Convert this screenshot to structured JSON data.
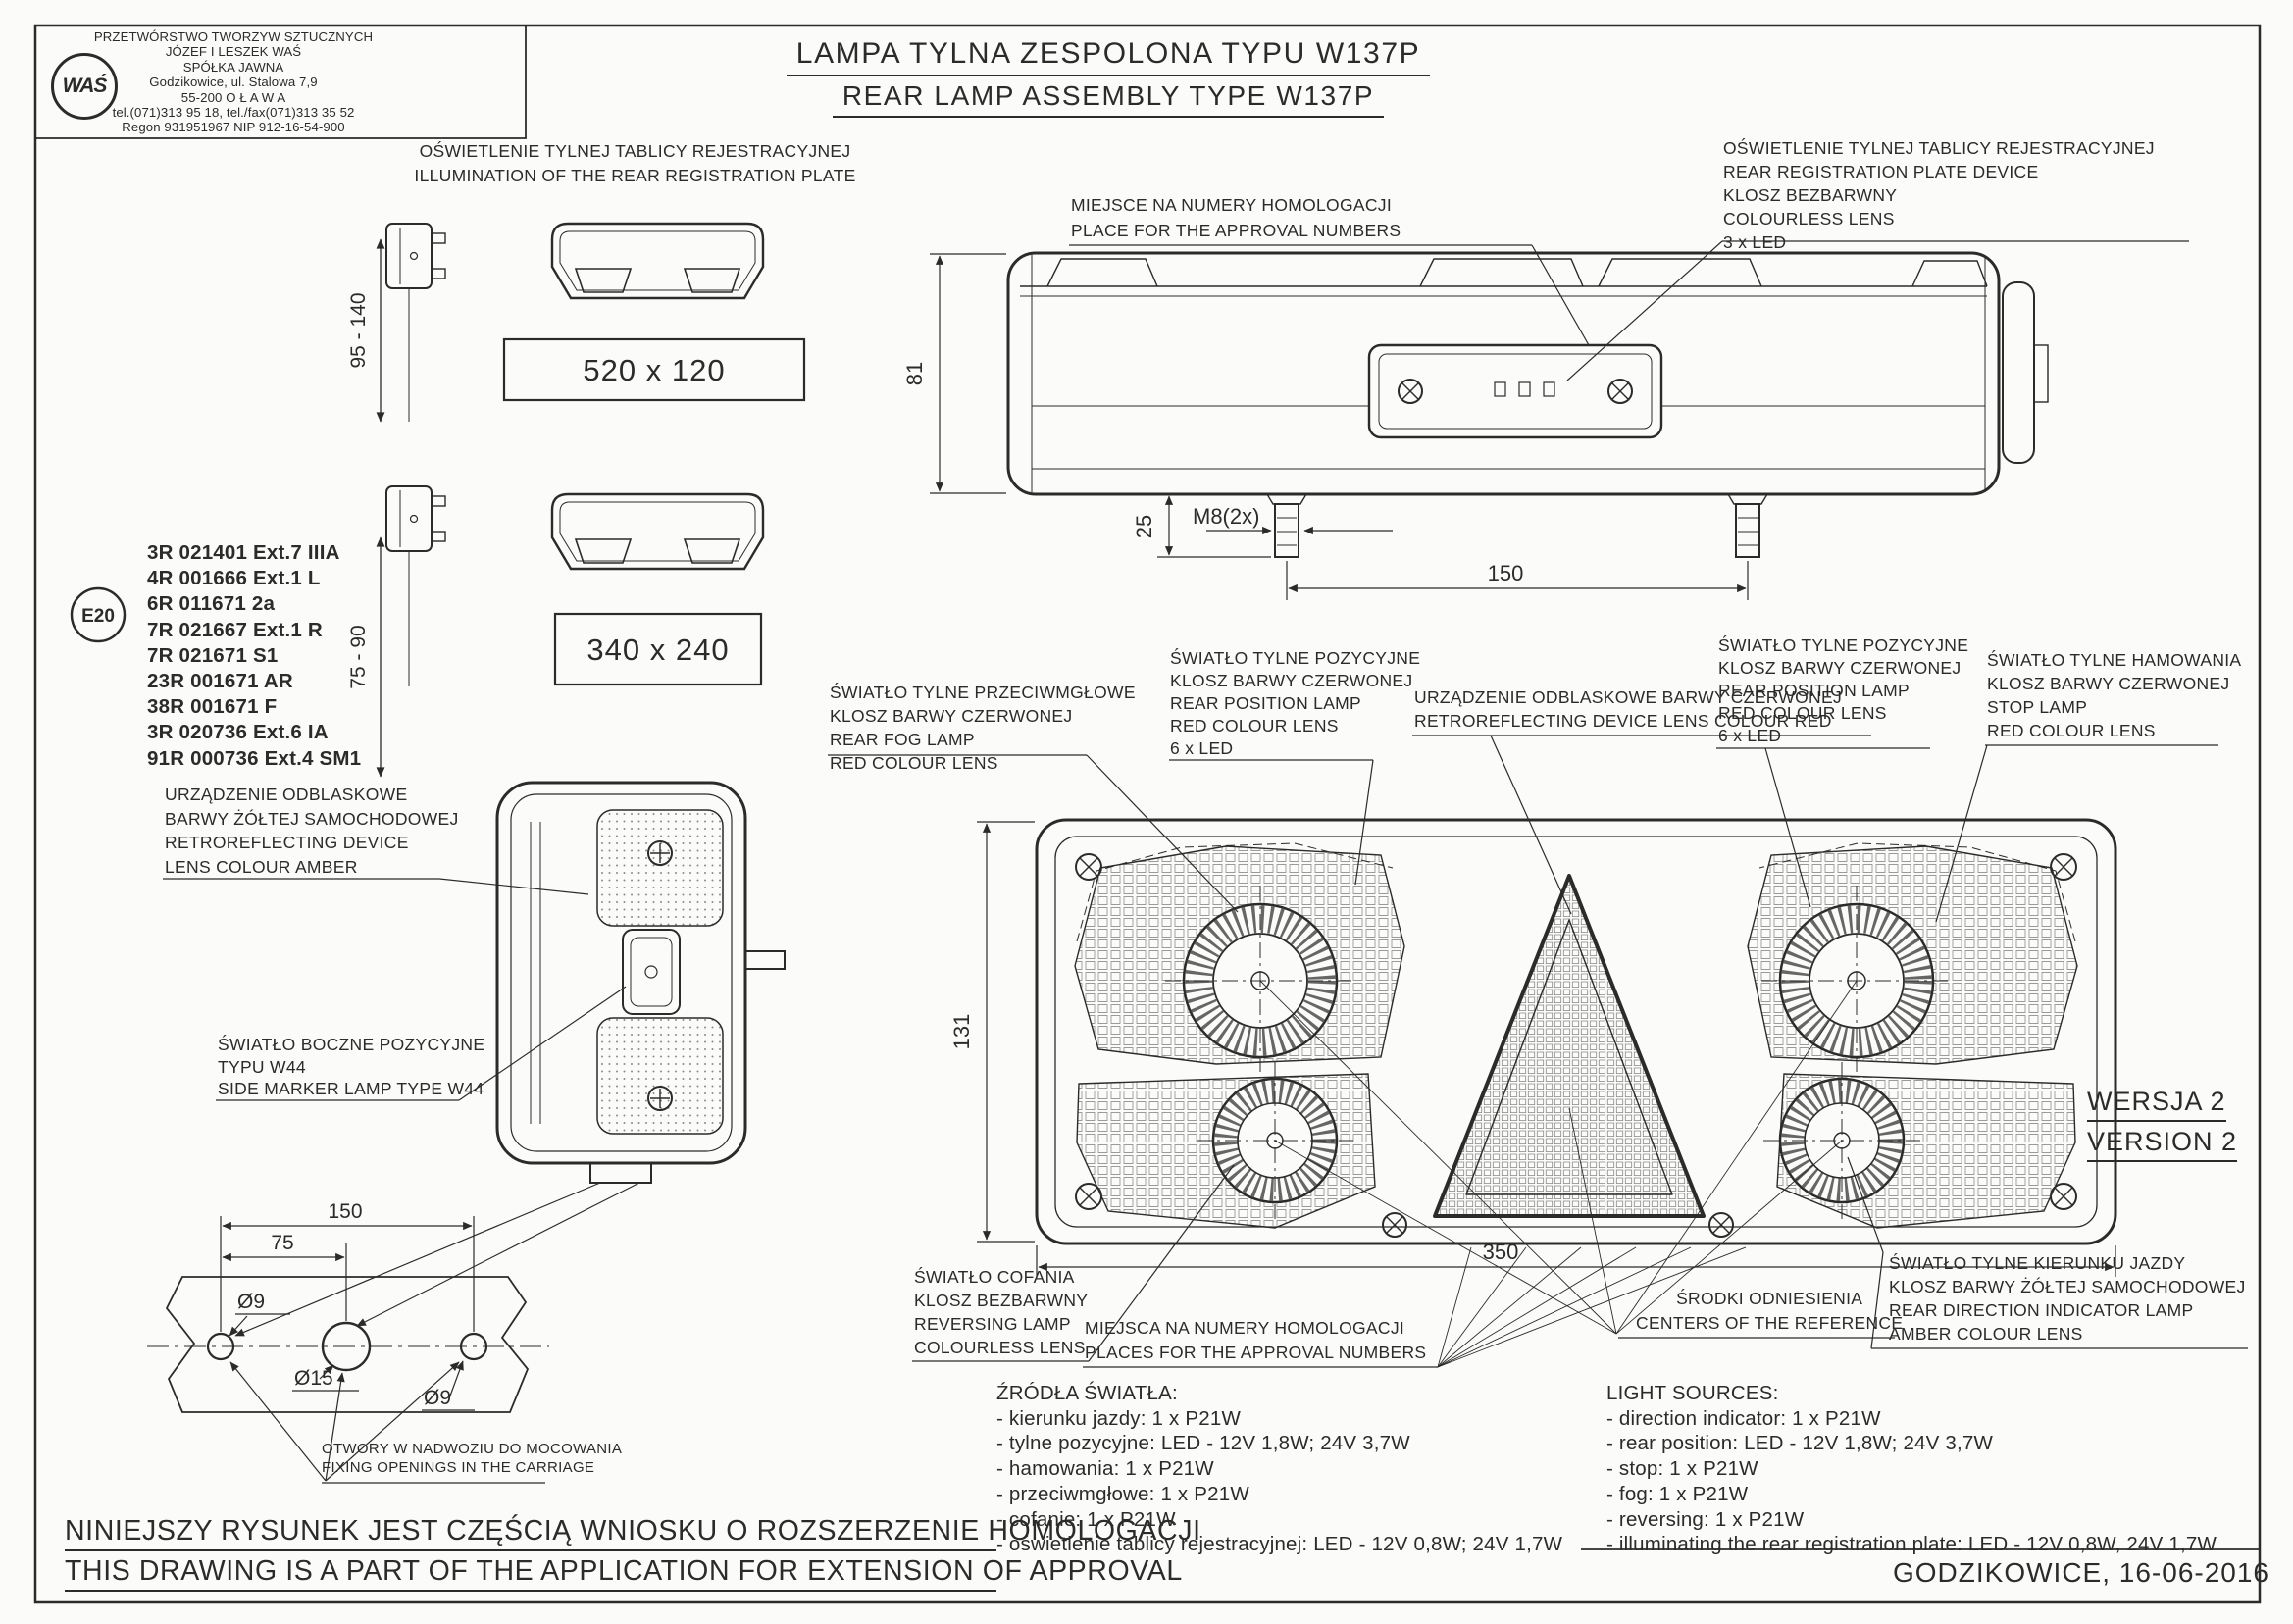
{
  "company": {
    "logo": "WAŚ",
    "lines": [
      "PRZETWÓRSTWO TWORZYW SZTUCZNYCH",
      "JÓZEF I LESZEK WAŚ",
      "SPÓŁKA JAWNA",
      "Godzikowice, ul. Stalowa 7,9",
      "55-200   O Ł A W A",
      "tel.(071)313 95 18, tel./fax(071)313 35 52",
      "Regon 931951967 NIP 912-16-54-900"
    ]
  },
  "title": {
    "pl": "LAMPA TYLNA ZESPOLONA TYPU W137P",
    "en": "REAR LAMP ASSEMBLY TYPE W137P"
  },
  "e_mark": "E20",
  "approvals": [
    "3R 021401 Ext.7 IIIA",
    "4R 001666 Ext.1 L",
    "6R 011671 2a",
    "7R 021667 Ext.1 R",
    "7R 021671 S1",
    "23R 001671 AR",
    "38R 001671 F",
    "3R 020736 Ext.6 IA",
    "91R 000736 Ext.4 SM1"
  ],
  "reg_plate": {
    "heading": [
      "OŚWIETLENIE TYLNEJ TABLICY REJESTRACYJNEJ",
      "ILLUMINATION OF THE REAR REGISTRATION PLATE"
    ],
    "size_large": "520 x 120",
    "size_small": "340 x 240",
    "range_large": "95 - 140",
    "range_small": "75 - 90"
  },
  "labels": {
    "place_top": [
      "MIEJSCE NA NUMERY HOMOLOGACJI",
      "PLACE FOR THE APPROVAL NUMBERS"
    ],
    "reg_device": [
      "OŚWIETLENIE TYLNEJ TABLICY REJESTRACYJNEJ",
      "REAR REGISTRATION PLATE DEVICE",
      "KLOSZ BEZBARWNY",
      "COLOURLESS LENS",
      "3 x LED"
    ],
    "amber_reflector": [
      "URZĄDZENIE ODBLASKOWE",
      "BARWY ŻÓŁTEJ SAMOCHODOWEJ",
      "RETROREFLECTING DEVICE",
      "LENS COLOUR AMBER"
    ],
    "side_marker": [
      "ŚWIATŁO BOCZNE POZYCYJNE",
      "TYPU W44",
      "SIDE MARKER LAMP  TYPE W44"
    ],
    "fog": [
      "ŚWIATŁO TYLNE PRZECIWMGŁOWE",
      "KLOSZ BARWY CZERWONEJ",
      "REAR FOG LAMP",
      "RED COLOUR LENS"
    ],
    "position_left": [
      "ŚWIATŁO TYLNE POZYCYJNE",
      "KLOSZ BARWY CZERWONEJ",
      "REAR POSITION LAMP",
      "RED COLOUR LENS",
      "6 x LED"
    ],
    "retro_red": [
      "URZĄDZENIE ODBLASKOWE BARWY CZERWONEJ",
      "RETROREFLECTING DEVICE LENS COLOUR RED"
    ],
    "position_right": [
      "ŚWIATŁO TYLNE POZYCYJNE",
      "KLOSZ BARWY CZERWONEJ",
      "REAR POSITION LAMP",
      "RED COLOUR LENS",
      "6 x LED"
    ],
    "stop": [
      "ŚWIATŁO TYLNE  HAMOWANIA",
      "KLOSZ BARWY CZERWONEJ",
      "STOP LAMP",
      "RED COLOUR LENS"
    ],
    "reversing": [
      "ŚWIATŁO COFANIA",
      "KLOSZ BEZBARWNY",
      "REVERSING LAMP",
      "COLOURLESS LENS"
    ],
    "places_bottom": [
      "MIEJSCA NA NUMERY HOMOLOGACJI",
      "PLACES FOR THE APPROVAL NUMBERS"
    ],
    "centers": [
      "ŚRODKI ODNIESIENIA",
      "CENTERS OF THE REFERENCE"
    ],
    "direction": [
      "ŚWIATŁO TYLNE KIERUNKU JAZDY",
      "KLOSZ BARWY ŻÓŁTEJ SAMOCHODOWEJ",
      "REAR DIRECTION INDICATOR LAMP",
      "AMBER COLOUR LENS"
    ],
    "fixing_openings": [
      "OTWORY W NADWOZIU DO MOCOWANIA",
      "FIXING OPENINGS IN THE CARRIAGE"
    ]
  },
  "dims": {
    "rear_height": "81",
    "stud_offset": "25",
    "stud_thread": "M8(2x)",
    "stud_spacing": "150",
    "front_height": "131",
    "front_width": "350",
    "hole_left": "Ø9",
    "hole_center": "Ø15",
    "hole_right": "Ø9",
    "holes_span": "150",
    "holes_half": "75"
  },
  "version": [
    "WERSJA 2",
    "VERSION 2"
  ],
  "sources_pl": [
    "ŹRÓDŁA ŚWIATŁA:",
    "- kierunku jazdy: 1 x P21W",
    "- tylne pozycyjne: LED - 12V 1,8W;   24V 3,7W",
    "- hamowania: 1 x P21W",
    "- przeciwmgłowe: 1 x P21W",
    "- cofanie:  1 x P21W",
    "- oświetlenie tablicy rejestracyjnej: LED - 12V 0,8W;  24V 1,7W"
  ],
  "sources_en": [
    "LIGHT SOURCES:",
    "- direction indicator: 1 x P21W",
    "- rear position: LED - 12V 1,8W;   24V 3,7W",
    "- stop: 1 x P21W",
    "- fog: 1 x P21W",
    "- reversing: 1 x P21W",
    "- illuminating the rear registration plate: LED - 12V 0,8W,  24V 1,7W"
  ],
  "footer": [
    "NINIEJSZY RYSUNEK JEST CZĘŚCIĄ  WNIOSKU O  ROZSZERZENIE HOMOLOGACJI",
    "THIS DRAWING IS A PART OF THE APPLICATION FOR EXTENSION OF  APPROVAL"
  ],
  "issue": "GODZIKOWICE,  16-06-2016",
  "colors": {
    "ink": "#2b2b2b",
    "paper": "#fbfbf9"
  }
}
